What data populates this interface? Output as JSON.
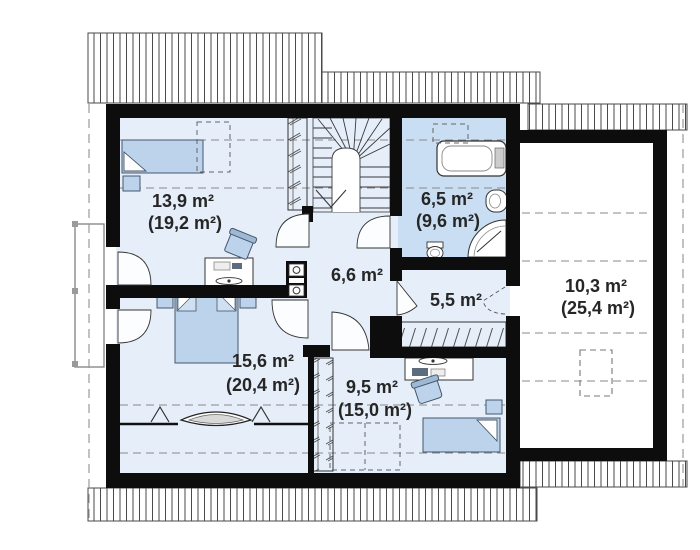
{
  "plan": {
    "type": "floor-plan-second-storey",
    "colors": {
      "wall": "#0d0d0d",
      "room_fill": "#e6eff9",
      "bathroom_fill": "#c9def2",
      "attic_fill": "#ffffff",
      "furniture_fill": "#bdd3eb",
      "label_text": "#262626",
      "roof_hatch_line": "#4a4a4a",
      "dashed_line": "#8a8a8a"
    },
    "rooms": [
      {
        "name": "bedroom-upper-left",
        "area": "13,9 m²",
        "area_total": "(19,2 m²)"
      },
      {
        "name": "bathroom",
        "area": "6,5 m²",
        "area_total": "(9,6 m²)"
      },
      {
        "name": "hall",
        "area": "6,6 m²",
        "area_total": ""
      },
      {
        "name": "corridor",
        "area": "5,5 m²",
        "area_total": ""
      },
      {
        "name": "attic-storage",
        "area": "10,3 m²",
        "area_total": "(25,4 m²)"
      },
      {
        "name": "bedroom-lower-left",
        "area": "15,6 m²",
        "area_total": "(20,4 m²)"
      },
      {
        "name": "room-lower-middle",
        "area": "9,5 m²",
        "area_total": "(15,0 m²)"
      }
    ]
  }
}
